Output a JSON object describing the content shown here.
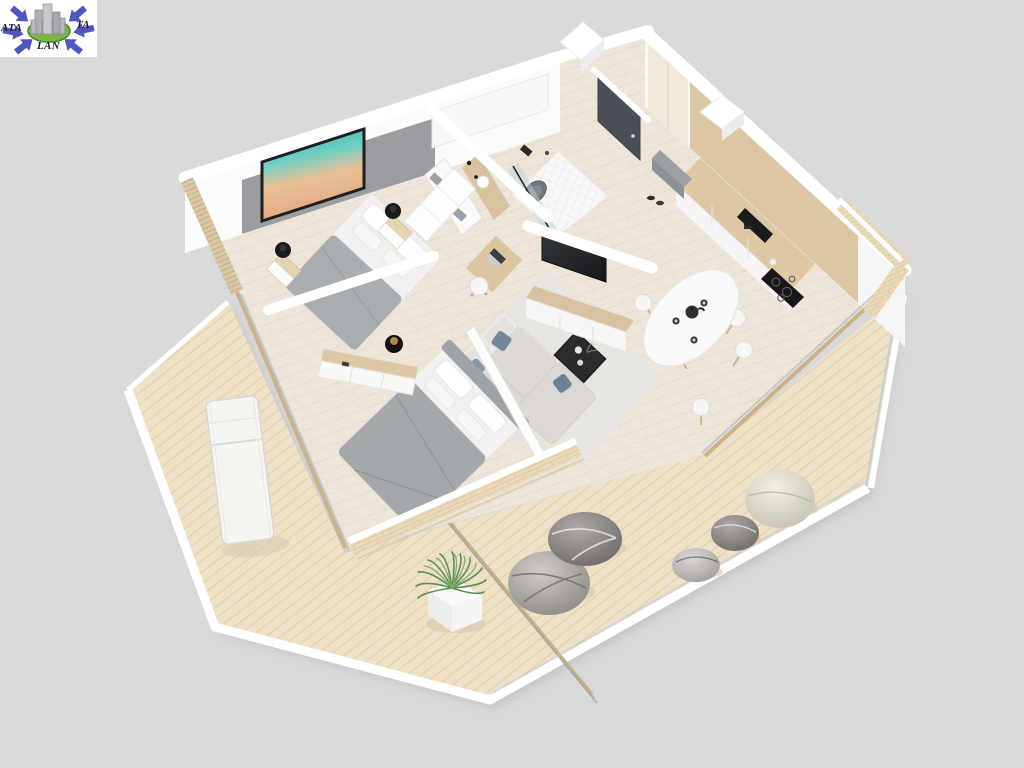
{
  "page": {
    "background": "#d9d9d9",
    "width": 1024,
    "height": 768
  },
  "logo": {
    "letters_left": "ATA",
    "letters_right": "TA",
    "letters_bottom": "LAN",
    "arrow_color": "#5156bd",
    "ring_color": "#7ab648",
    "buildings_color": "#b9b9bd",
    "panel_color": "#ffffff",
    "text_color": "#1c1c30"
  },
  "scene": {
    "kind": "isometric-3d-apartment-floor-plan-render",
    "rooms": [
      {
        "name": "Bedroom 1",
        "items": [
          "beach artwork in black frame",
          "gray upholstered headboard wall",
          "double bed with white pillows and gray throw",
          "2 oak nightstands",
          "2 black table lamps",
          "white wardrobe",
          "oak desk with laptop",
          "white stool",
          "slatted wood feature wall",
          "floor-to-ceiling window"
        ]
      },
      {
        "name": "Bathroom",
        "items": [
          "walk-in shower with black-framed glass",
          "gray wall-hung toilet",
          "flush plate",
          "oak vanity with round basin",
          "black tap",
          "white shelf with gray towels",
          "small white floor tiles"
        ]
      },
      {
        "name": "Entrance hall",
        "items": [
          "graphite entry door",
          "oak built-in wardrobe",
          "gray bench",
          "shoes",
          "white service shaft"
        ]
      },
      {
        "name": "Kitchen",
        "items": [
          "white cabinet run",
          "oak wall paneling",
          "black undermount sink",
          "black induction hob",
          "black coffee maker"
        ]
      },
      {
        "name": "Dining area",
        "items": [
          "white oval table",
          "7 white chairs with wooden legs",
          "black teapot",
          "3 espresso cups"
        ]
      },
      {
        "name": "Living room",
        "items": [
          "light gray corner sofa",
          "blue-gray cushions",
          "black square coffee table",
          "light area rug",
          "wall-mounted TV",
          "oak media console with white drawers"
        ]
      },
      {
        "name": "Bedroom 2",
        "items": [
          "double bed with gray duvet",
          "gray upholstered headboard",
          "oak sideboard with white drawers",
          "black table lamp",
          "white partition wall"
        ]
      },
      {
        "name": "Terrace",
        "items": [
          "diagonal wood decking",
          "white sun lounger",
          "ornamental grass in white cube planter",
          "5 decorative boulders",
          "brick parapet with white cap",
          "glass balustrade with wooden handrail",
          "brick exterior corner wall"
        ]
      }
    ],
    "palette": {
      "background": "#d9d9d9",
      "walls": "#ffffff",
      "floor": "#ece5d8",
      "deck": "#eee1c8",
      "oak": "#dcc6a4",
      "upholstery_gray": "#a3a7aa",
      "sofa": "#dcd9d4",
      "charcoal": "#2c2d2f",
      "door": "#4b4f55",
      "brick": "#ead9ba",
      "art_teal": "#35b4ab",
      "art_sand": "#e9b68c",
      "plant_green": "#5d8f54"
    }
  }
}
